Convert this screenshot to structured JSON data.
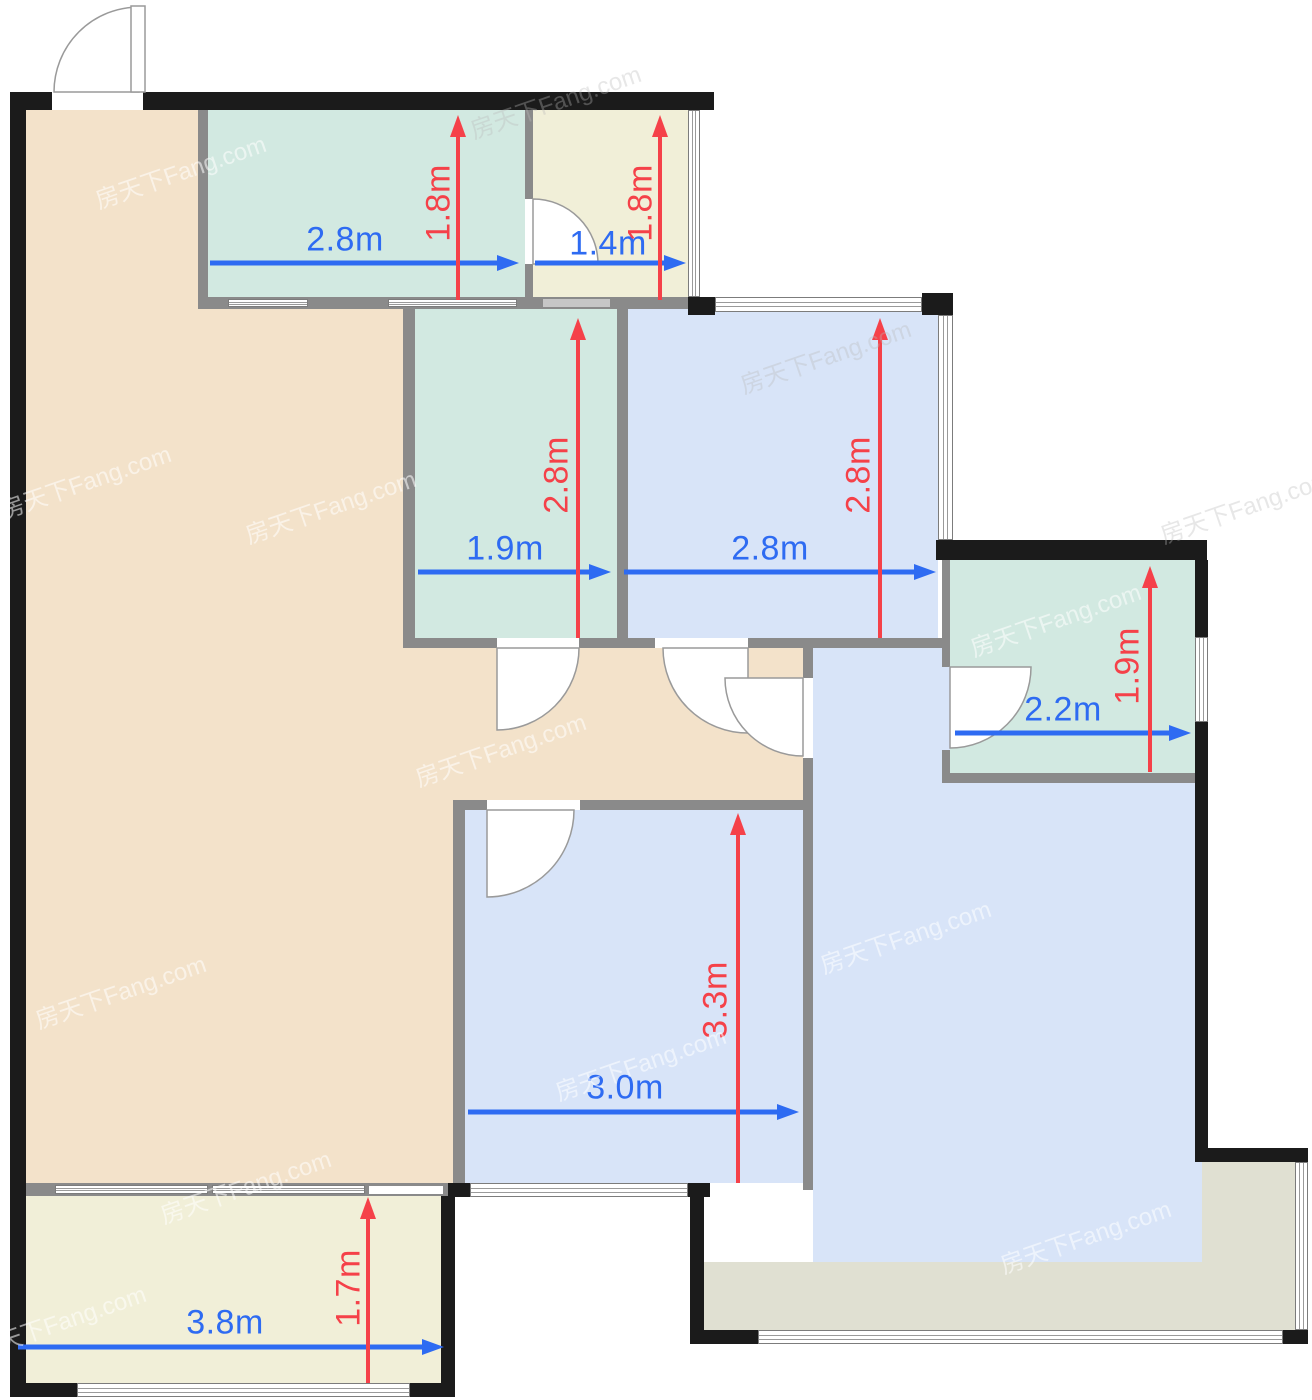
{
  "watermark": {
    "text": "房天下Fang.com"
  },
  "colors": {
    "wall": "#1b1b1b",
    "interior_wall": "#8a8a8a",
    "room_tan": "#f3e2ca",
    "room_teal": "#d2e9e1",
    "room_cream": "#f1efd8",
    "room_blue": "#d8e4f8",
    "room_khaki": "#e0e0d2",
    "dim_blue": "#2e6bf2",
    "dim_red": "#f54149",
    "window": "#ffffff"
  },
  "dimensions": {
    "top_left_room": {
      "width": "2.8m",
      "depth": "1.8m"
    },
    "top_right_room": {
      "width": "1.4m",
      "depth": "1.8m"
    },
    "middle_left_room": {
      "width": "1.9m",
      "depth": "2.8m"
    },
    "middle_right_room": {
      "width": "2.8m",
      "depth": "2.8m"
    },
    "right_room": {
      "width": "2.2m",
      "depth": "1.9m"
    },
    "bottom_middle_room": {
      "width": "3.0m",
      "depth": "3.3m"
    },
    "bottom_balcony": {
      "width": "3.8m",
      "depth": "1.7m"
    }
  }
}
